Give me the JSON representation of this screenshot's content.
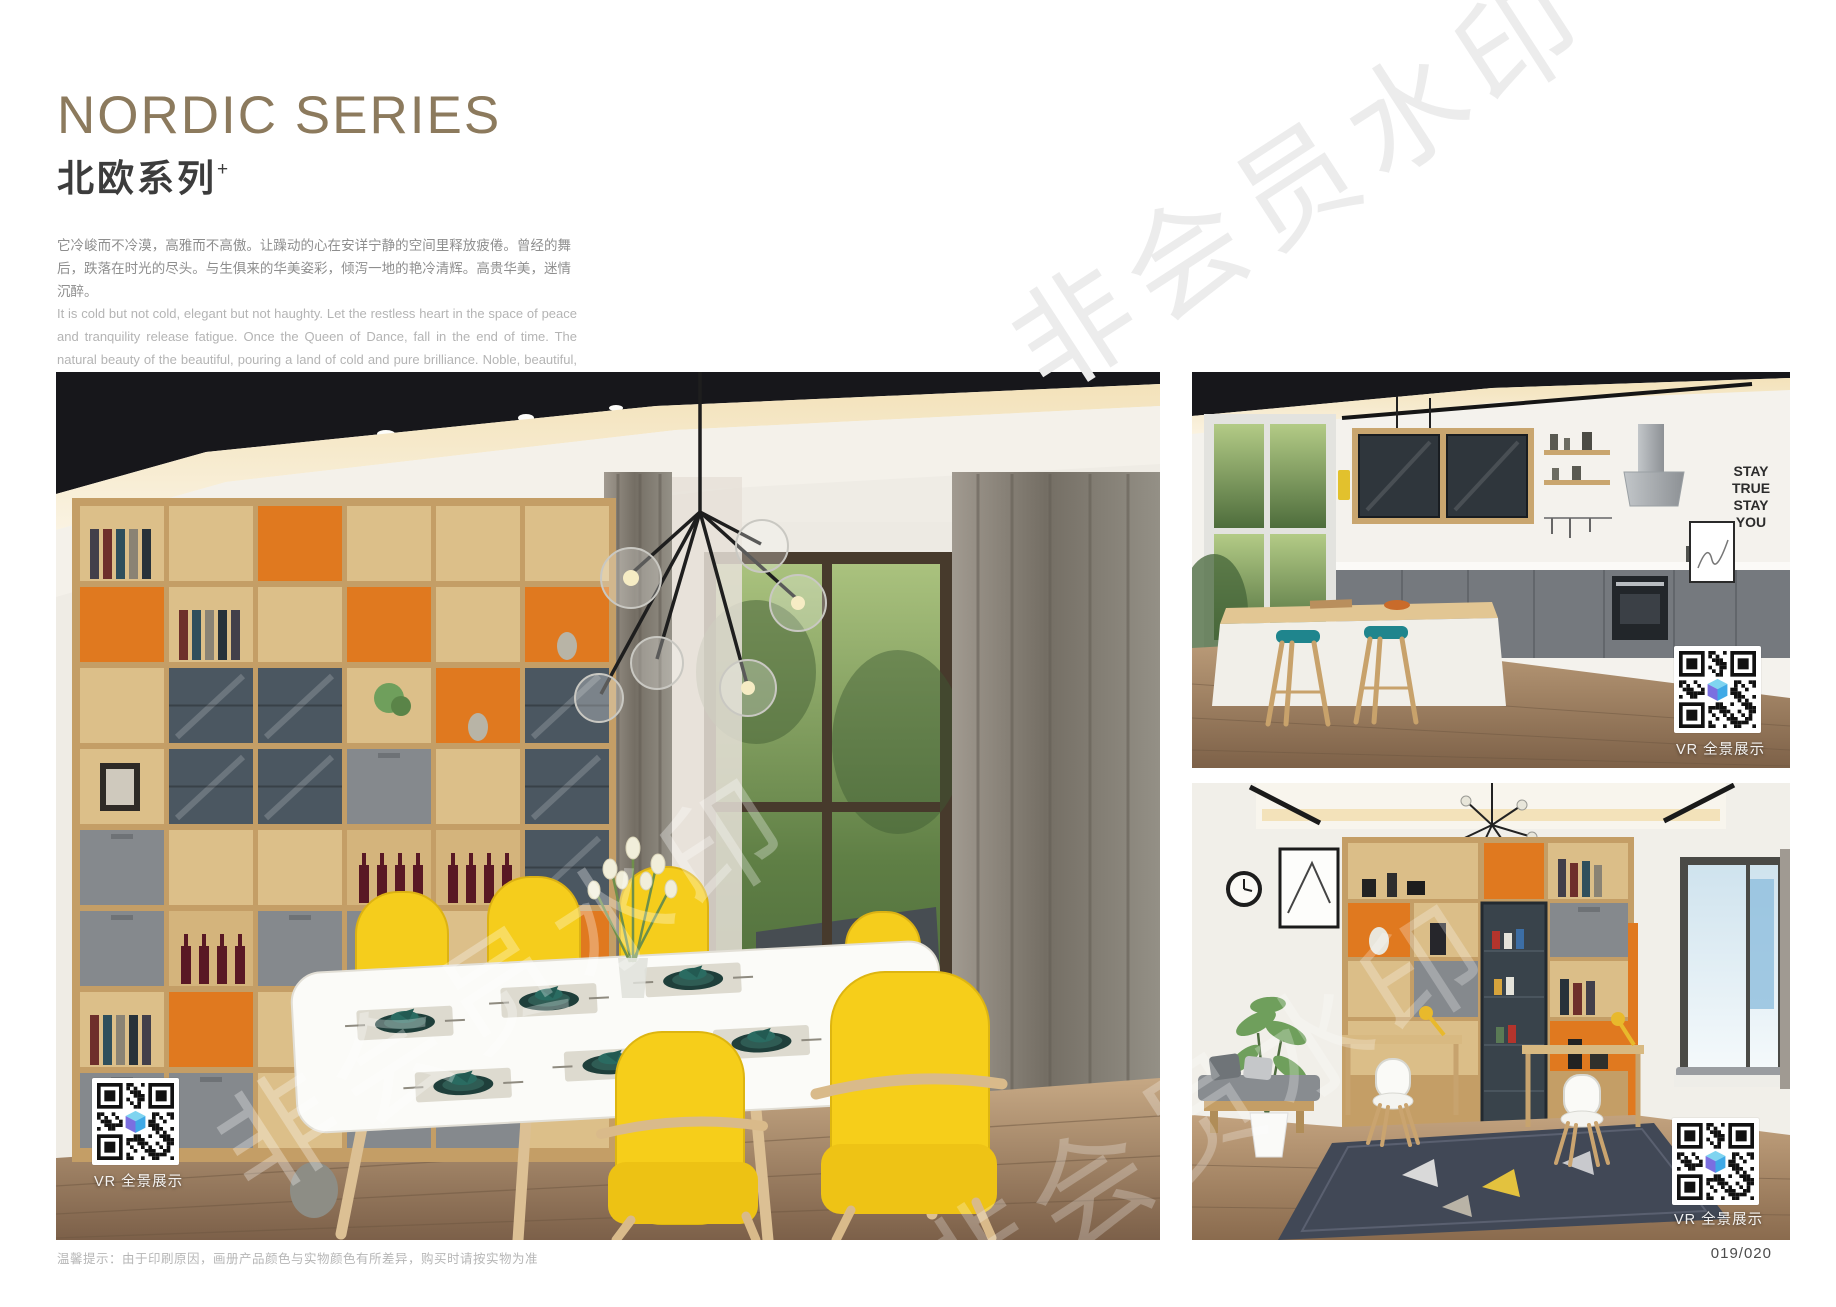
{
  "header": {
    "title_en": "NORDIC SERIES",
    "title_cn": "北欧系列",
    "title_suffix": "+",
    "intro_cn": "它冷峻而不冷漠，高雅而不高傲。让躁动的心在安详宁静的空间里释放疲倦。曾经的舞后，跌落在时光的尽头。与生俱来的华美姿彩，倾泻一地的艳冷清辉。高贵华美，迷情沉醉。",
    "intro_en": "It is cold but not cold, elegant but not haughty. Let the restless heart in the space of peace and tranquility release fatigue. Once the Queen of Dance, fall in the end of time. The natural beauty of the beautiful, pouring a land of cold and pure brilliance. Noble, beautiful, enchanted."
  },
  "photos": {
    "kitchen": {
      "wall_text": [
        "STAY",
        "TRUE",
        "STAY",
        "YOU"
      ]
    }
  },
  "vr_badge": {
    "label": "VR 全景展示"
  },
  "watermark": {
    "text": "非会员水印"
  },
  "footer": {
    "note": "温馨提示：由于印刷原因，画册产品颜色与实物颜色有所差异，购买时请按实物为准",
    "page_number": "019/020"
  },
  "colors": {
    "title_accent": "#8c7a5d",
    "shelf_orange": "#e0791f",
    "chair_yellow": "#f5cd1c",
    "stool_teal": "#1f858d",
    "wood": "#c49e66"
  }
}
